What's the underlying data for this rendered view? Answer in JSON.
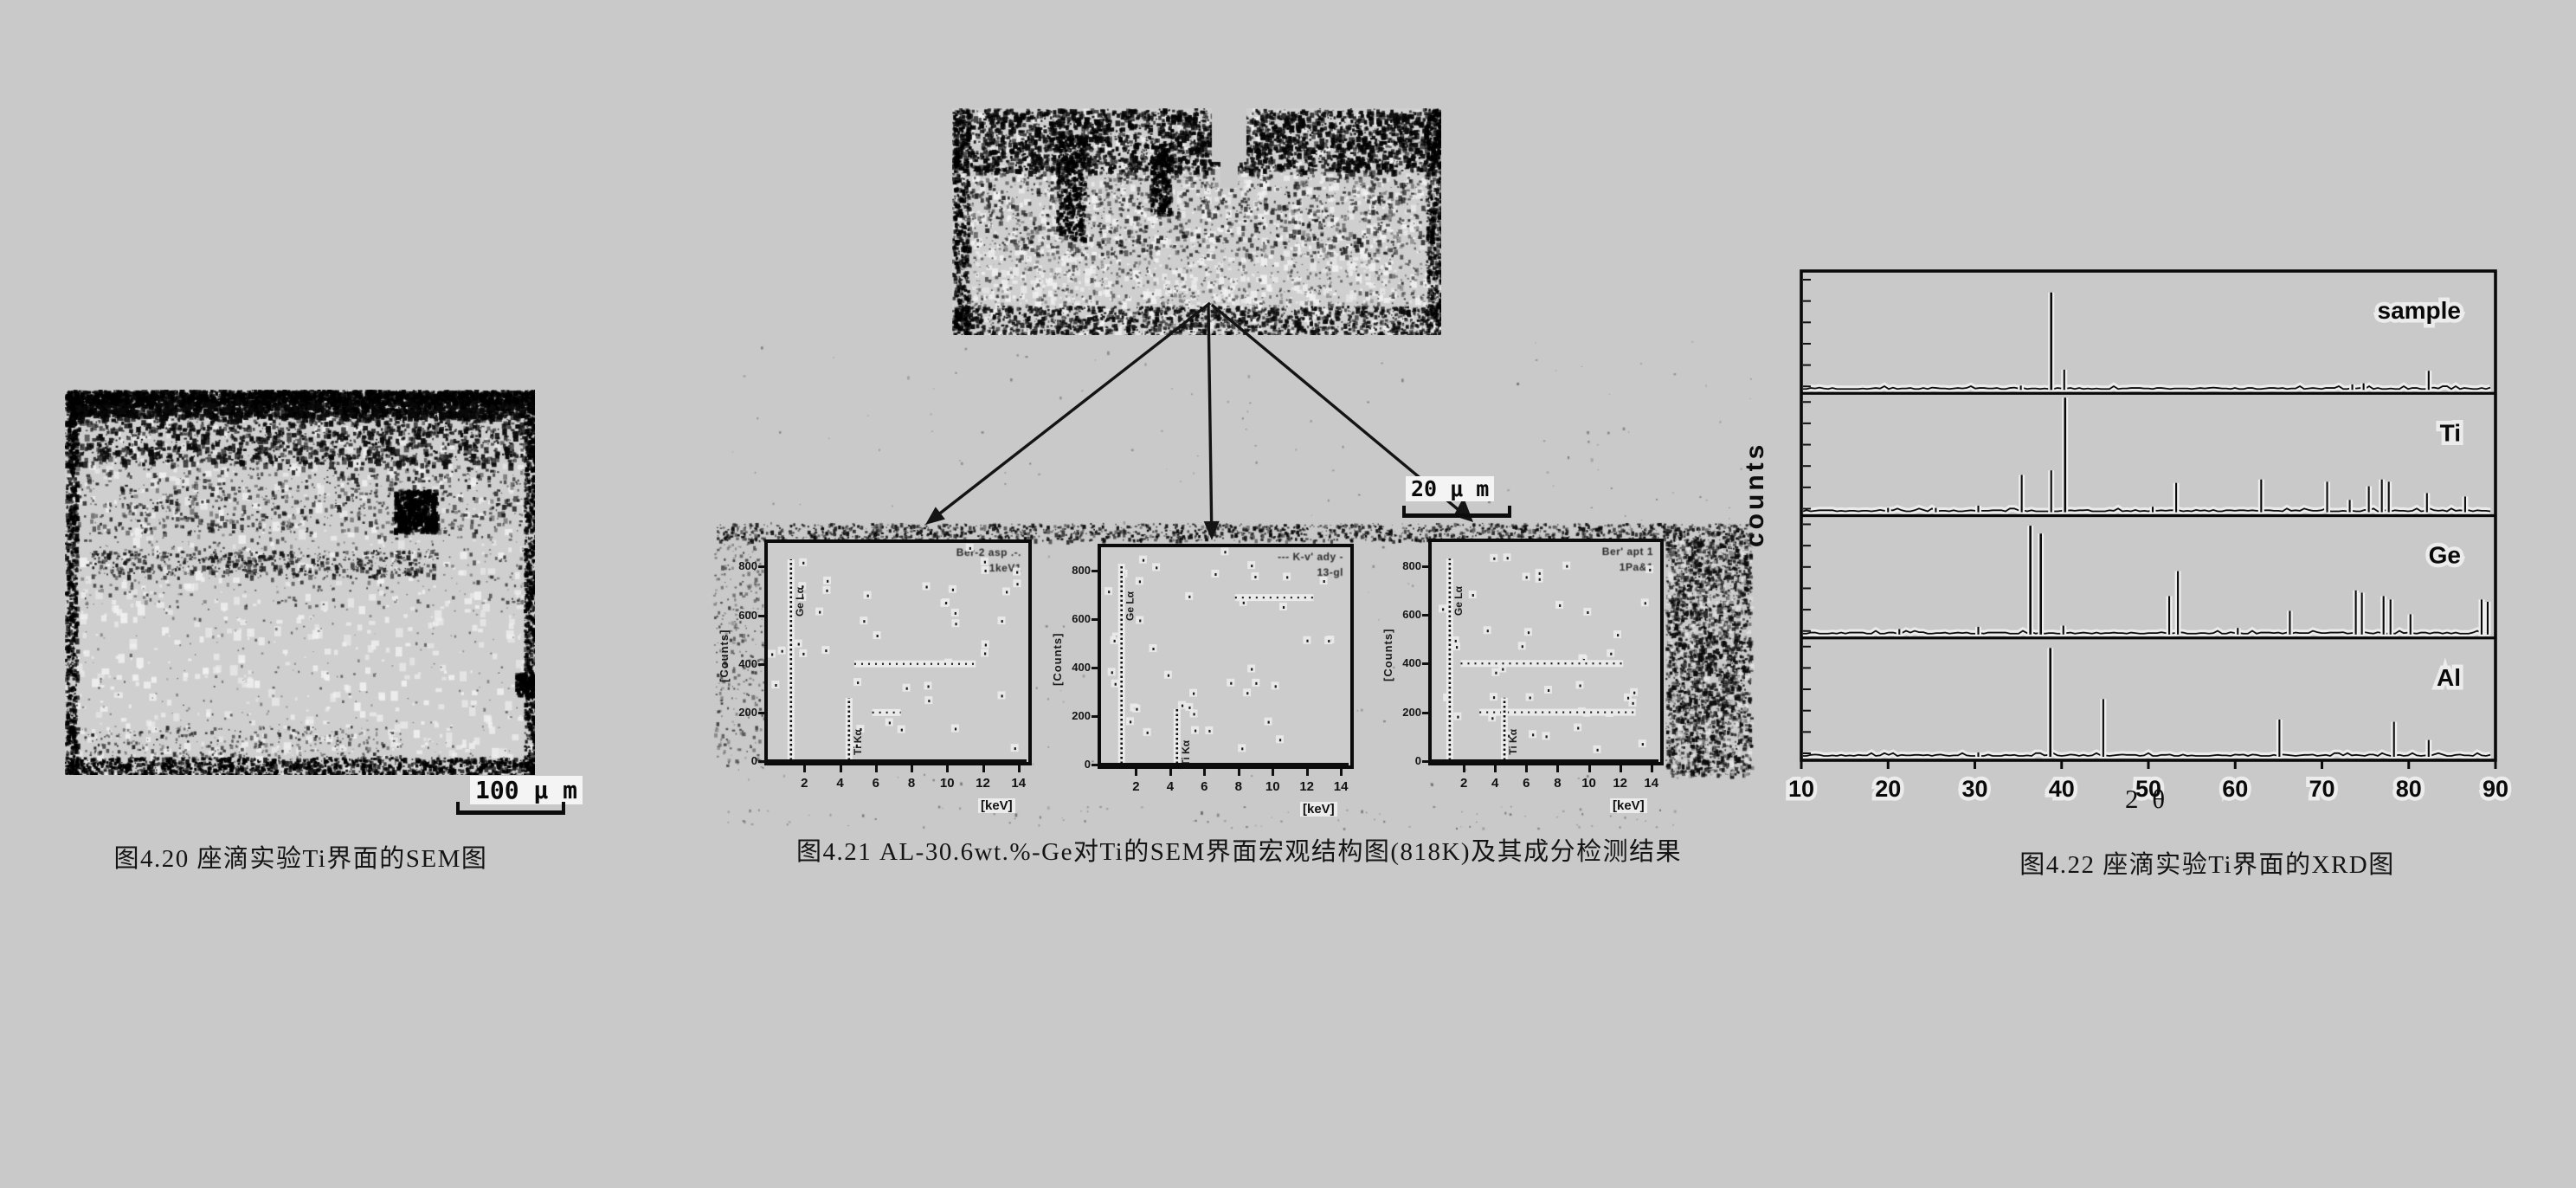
{
  "page": {
    "background": "#c9c9ca"
  },
  "fig20": {
    "caption": "图4.20 座滴实验Ti界面的SEM图",
    "image_name": "sem-image-ti-interface",
    "scale_bar": "100 μ m"
  },
  "fig21": {
    "caption": "图4.21 AL-30.6wt.%-Ge对Ti的SEM界面宏观结构图(818K)及其成分检测结果",
    "image_name": "sem-macro-image-al-ge-on-ti",
    "scale_bar": "20 μ m",
    "eds": {
      "xlabel": "[keV]",
      "ylabel": "[Counts]",
      "xticks": [
        2,
        4,
        6,
        8,
        10,
        12,
        14
      ],
      "yticks": [
        0,
        200,
        400,
        600,
        800
      ],
      "ylim": [
        0,
        880
      ],
      "panels": [
        {
          "annotation": [
            "Ber-2 asp .-.",
            "1keV1"
          ],
          "peaks": [
            {
              "kev": 1.25,
              "counts": 830,
              "label": "Ge Lα"
            },
            {
              "kev": 4.5,
              "counts": 260,
              "label": "Ti Kα"
            }
          ],
          "dot_rows": [
            [
              400,
              4.8,
              11.6
            ],
            [
              200,
              5.8,
              7.4
            ]
          ]
        },
        {
          "annotation": [
            "--- K-v' ady -",
            "13-gl"
          ],
          "peaks": [
            {
              "kev": 1.15,
              "counts": 830,
              "label": "Ge Lα"
            },
            {
              "kev": 4.4,
              "counts": 230,
              "label": "Ti Kα"
            }
          ],
          "dot_rows": [
            [
              690,
              7.8,
              12.4
            ]
          ]
        },
        {
          "annotation": [
            "Ber' apt 1",
            "1Pa&1"
          ],
          "peaks": [
            {
              "kev": 1.1,
              "counts": 830,
              "label": "Ge Lα"
            },
            {
              "kev": 4.6,
              "counts": 260,
              "label": "Ti Kα"
            }
          ],
          "dot_rows": [
            [
              400,
              1.8,
              12.2
            ],
            [
              200,
              3.0,
              13.0
            ]
          ]
        }
      ]
    }
  },
  "fig22": {
    "caption": "图4.22 座滴实验Ti界面的XRD图",
    "chart_data": {
      "type": "line",
      "subtype": "stacked XRD stick patterns, peak heights relative to panel height (estimated)",
      "xlabel": "2 θ",
      "ylabel": "counts",
      "xlim": [
        10,
        90
      ],
      "xticks": [
        10,
        20,
        30,
        40,
        50,
        60,
        70,
        80,
        90
      ],
      "grid": false,
      "legend_position": "label inside each panel, top-right",
      "panels": [
        {
          "label": "sample",
          "peaks": [
            [
              35.3,
              0.03
            ],
            [
              38.8,
              0.85
            ],
            [
              40.3,
              0.17
            ],
            [
              73.5,
              0.04
            ],
            [
              74.8,
              0.05
            ],
            [
              82.3,
              0.16
            ]
          ]
        },
        {
          "label": "Ti",
          "peaks": [
            [
              20.0,
              0.03
            ],
            [
              25.5,
              0.03
            ],
            [
              30.4,
              0.05
            ],
            [
              35.4,
              0.32
            ],
            [
              38.8,
              0.36
            ],
            [
              40.4,
              1.0
            ],
            [
              50.5,
              0.04
            ],
            [
              53.2,
              0.25
            ],
            [
              63.0,
              0.28
            ],
            [
              70.6,
              0.26
            ],
            [
              73.2,
              0.1
            ],
            [
              75.4,
              0.22
            ],
            [
              76.9,
              0.28
            ],
            [
              77.7,
              0.26
            ],
            [
              82.1,
              0.16
            ],
            [
              86.5,
              0.13
            ]
          ]
        },
        {
          "label": "Ge",
          "peaks": [
            [
              21.3,
              0.04
            ],
            [
              30.4,
              0.06
            ],
            [
              36.4,
              0.95
            ],
            [
              37.6,
              0.88
            ],
            [
              40.2,
              0.07
            ],
            [
              52.4,
              0.33
            ],
            [
              53.4,
              0.55
            ],
            [
              60.3,
              0.05
            ],
            [
              66.3,
              0.2
            ],
            [
              73.9,
              0.38
            ],
            [
              74.6,
              0.36
            ],
            [
              77.1,
              0.33
            ],
            [
              77.9,
              0.3
            ],
            [
              80.2,
              0.17
            ],
            [
              88.4,
              0.3
            ],
            [
              89.1,
              0.28
            ]
          ]
        },
        {
          "label": "Al",
          "peaks": [
            [
              30.4,
              0.03
            ],
            [
              38.7,
              0.95
            ],
            [
              44.8,
              0.5
            ],
            [
              65.1,
              0.32
            ],
            [
              78.3,
              0.3
            ],
            [
              82.3,
              0.14
            ]
          ]
        }
      ]
    }
  }
}
